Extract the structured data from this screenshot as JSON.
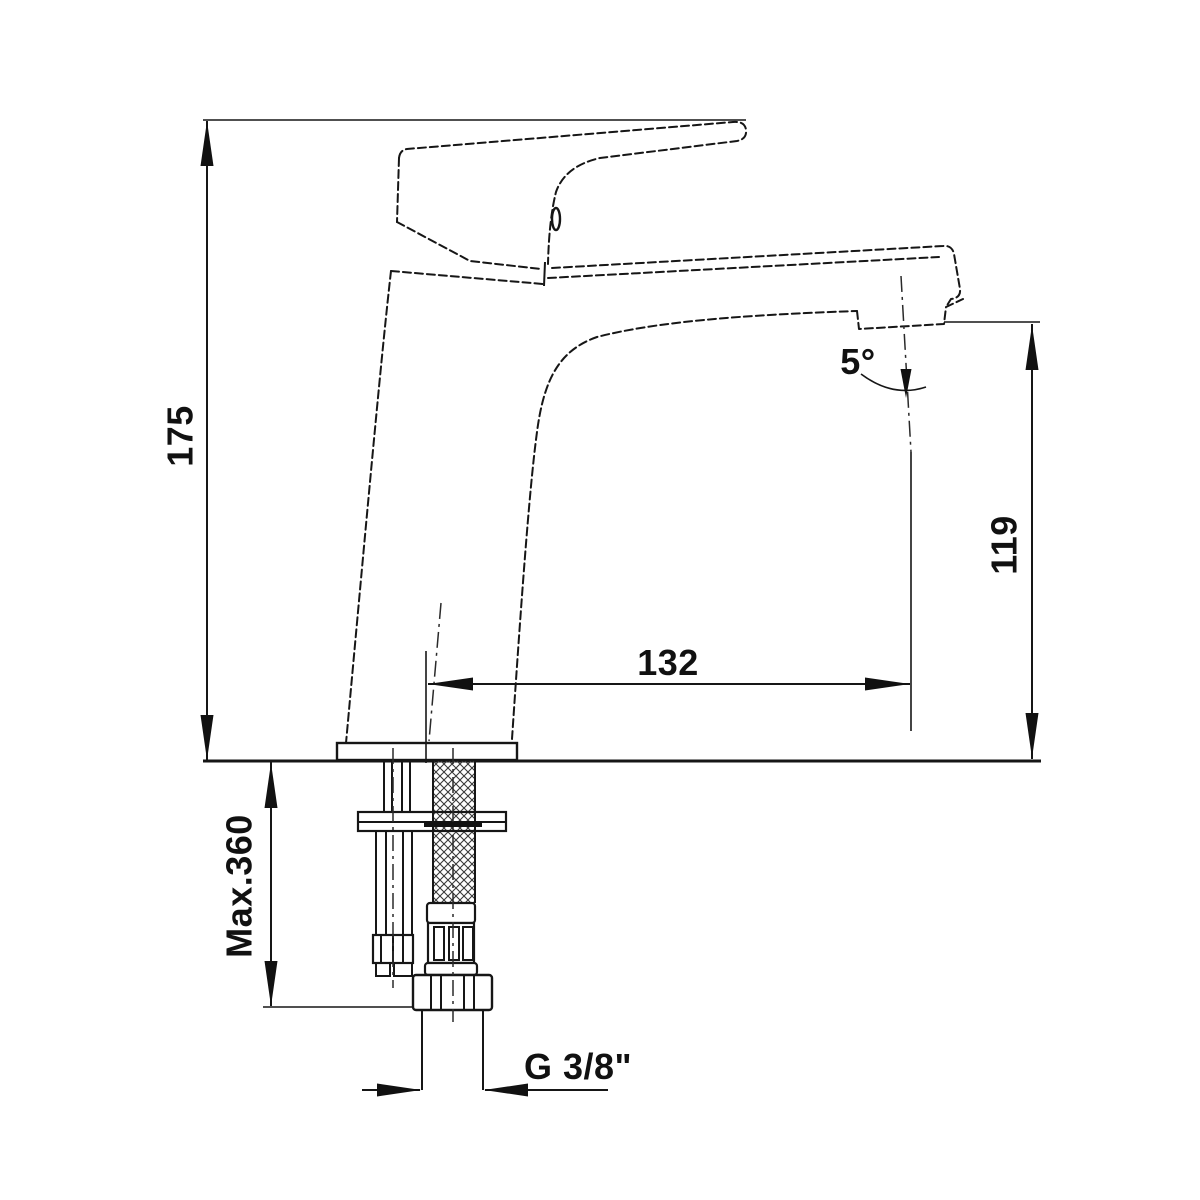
{
  "drawing": {
    "subject": "single-lever basin mixer faucet dimension drawing",
    "background_color": "#ffffff",
    "line_color": "#161616"
  },
  "dimensions": {
    "overall_height": "175",
    "outlet_height": "119",
    "spout_reach": "132",
    "outlet_angle": "5°",
    "max_installation_depth": "Max.360",
    "connection_thread": "G 3/8\""
  }
}
